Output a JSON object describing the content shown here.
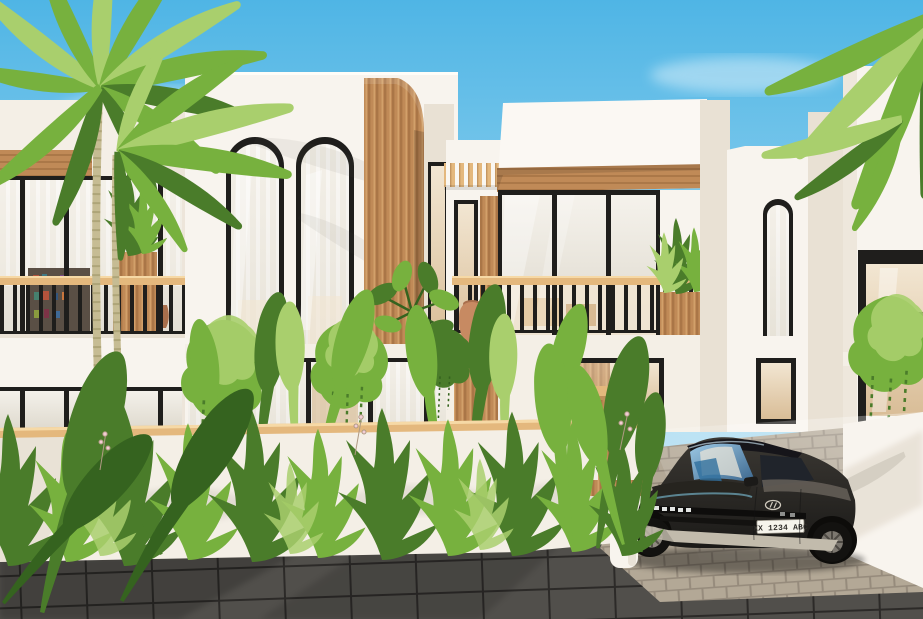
{
  "scene": {
    "type": "3d-architectural-exterior-render",
    "subject": "Modern tropical white villas with arched windows, timber slat accents, palm trees and a parked electric car",
    "vehicle": {
      "kind": "electric hatchback",
      "body_color_name": "dark graphite",
      "license_plate": "XX 1234 ABC",
      "brand_logo": "hyundai-logo"
    },
    "landscaping": [
      "palm-trees",
      "hanging-plants",
      "tropical-shrubs",
      "monstera"
    ],
    "materials": [
      "white-stucco",
      "timber-slats",
      "black-window-frames",
      "grey-block-pavers",
      "dark-stone-slabs"
    ]
  },
  "colors": {
    "sky-top": "#4fb5e5",
    "sky-mid": "#8ed0ee",
    "sky-low": "#d3ecf6",
    "cloud": "#ffffff",
    "wall": "#f8f4ee",
    "wall-warm": "#f4efe6",
    "wall-shade": "#e9e1d4",
    "wall-dark": "#d9cfbf",
    "frame": "#1f1e1c",
    "wood": "#c08a57",
    "wood-light": "#e4b87d",
    "wood-deep": "#96663a",
    "glass-hi": "#f6f3ed",
    "glass-lo": "#ddd8cc",
    "warm-hi": "#f2e6d2",
    "warm-lo": "#d9bd97",
    "leaf": "#77b13e",
    "leaf-light": "#a9cf6d",
    "leaf-dark": "#4a7c2a",
    "leaf-deep": "#35631f",
    "trunk": "#c6bc93",
    "trunk-ring": "#a89f72",
    "terracotta": "#c78a62",
    "terracotta-shade": "#a96f4c",
    "paver": "#b3a896",
    "paver-gap": "#968b7c",
    "slab": "#514f4b",
    "slab-gap": "#2c2a28",
    "car-body-hi": "#3b3833",
    "car-body-lo": "#1b1a18",
    "car-glass-hi": "#9cc8e4",
    "car-glass-lo": "#39648b",
    "car-trim": "#c2bbac",
    "plate-bg": "#f6f4ec",
    "plate-text": "#2f2d29"
  }
}
